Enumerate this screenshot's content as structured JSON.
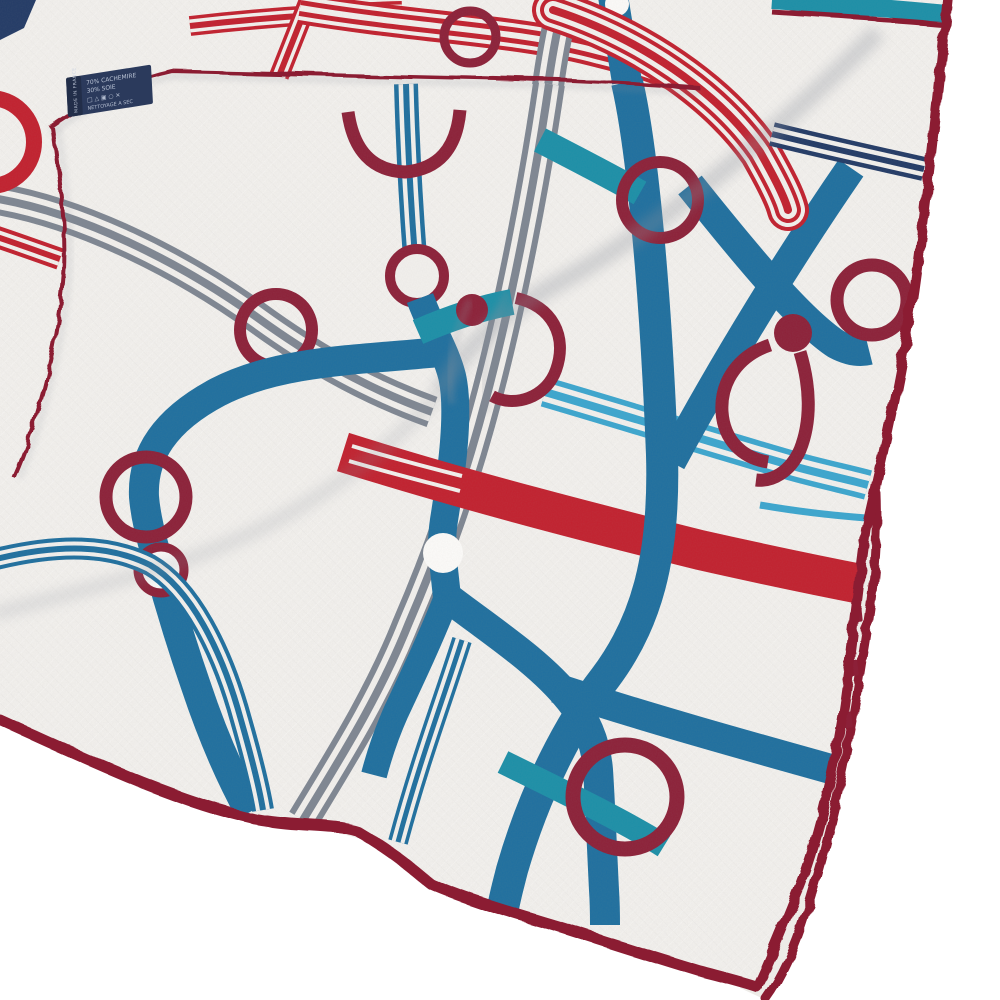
{
  "photo": {
    "type": "product photograph",
    "subject": "Folded white cashmere-silk scarf with a red, blue, teal and grey ribbon-and-ring print, burgundy hand-rolled hems and a navy care label",
    "background_color": "#ffffff"
  },
  "scarf": {
    "fabric_description": "white linen-texture weave",
    "motifs": [
      "striped ribbons",
      "rings",
      "buckle links",
      "white dots",
      "circuit connectors"
    ],
    "palette": {
      "red": "#c2202e",
      "burg": "#8c2038",
      "blue": "#1e6f9f",
      "teal": "#1b8fa8",
      "cyan": "#3ba6cf",
      "navy": "#223a66",
      "gray": "#7e8692",
      "fab": "#f3f1ee",
      "fabBack": "#edebe7",
      "fabBright": "#fdfcfa",
      "hem": "#8b1e33",
      "labelBg": "#2b3a5c",
      "labelBgDark": "#222e49",
      "labelText": "#c9d2e2",
      "shadow": "#8c929c"
    }
  },
  "care_label": {
    "side_text": "MADE IN FRANCE",
    "lines": [
      "70% CACHEMIRE",
      "30% SOIE",
      "□ △ ▣ ○ ✕",
      "NETTOYAGE A SEC"
    ]
  }
}
